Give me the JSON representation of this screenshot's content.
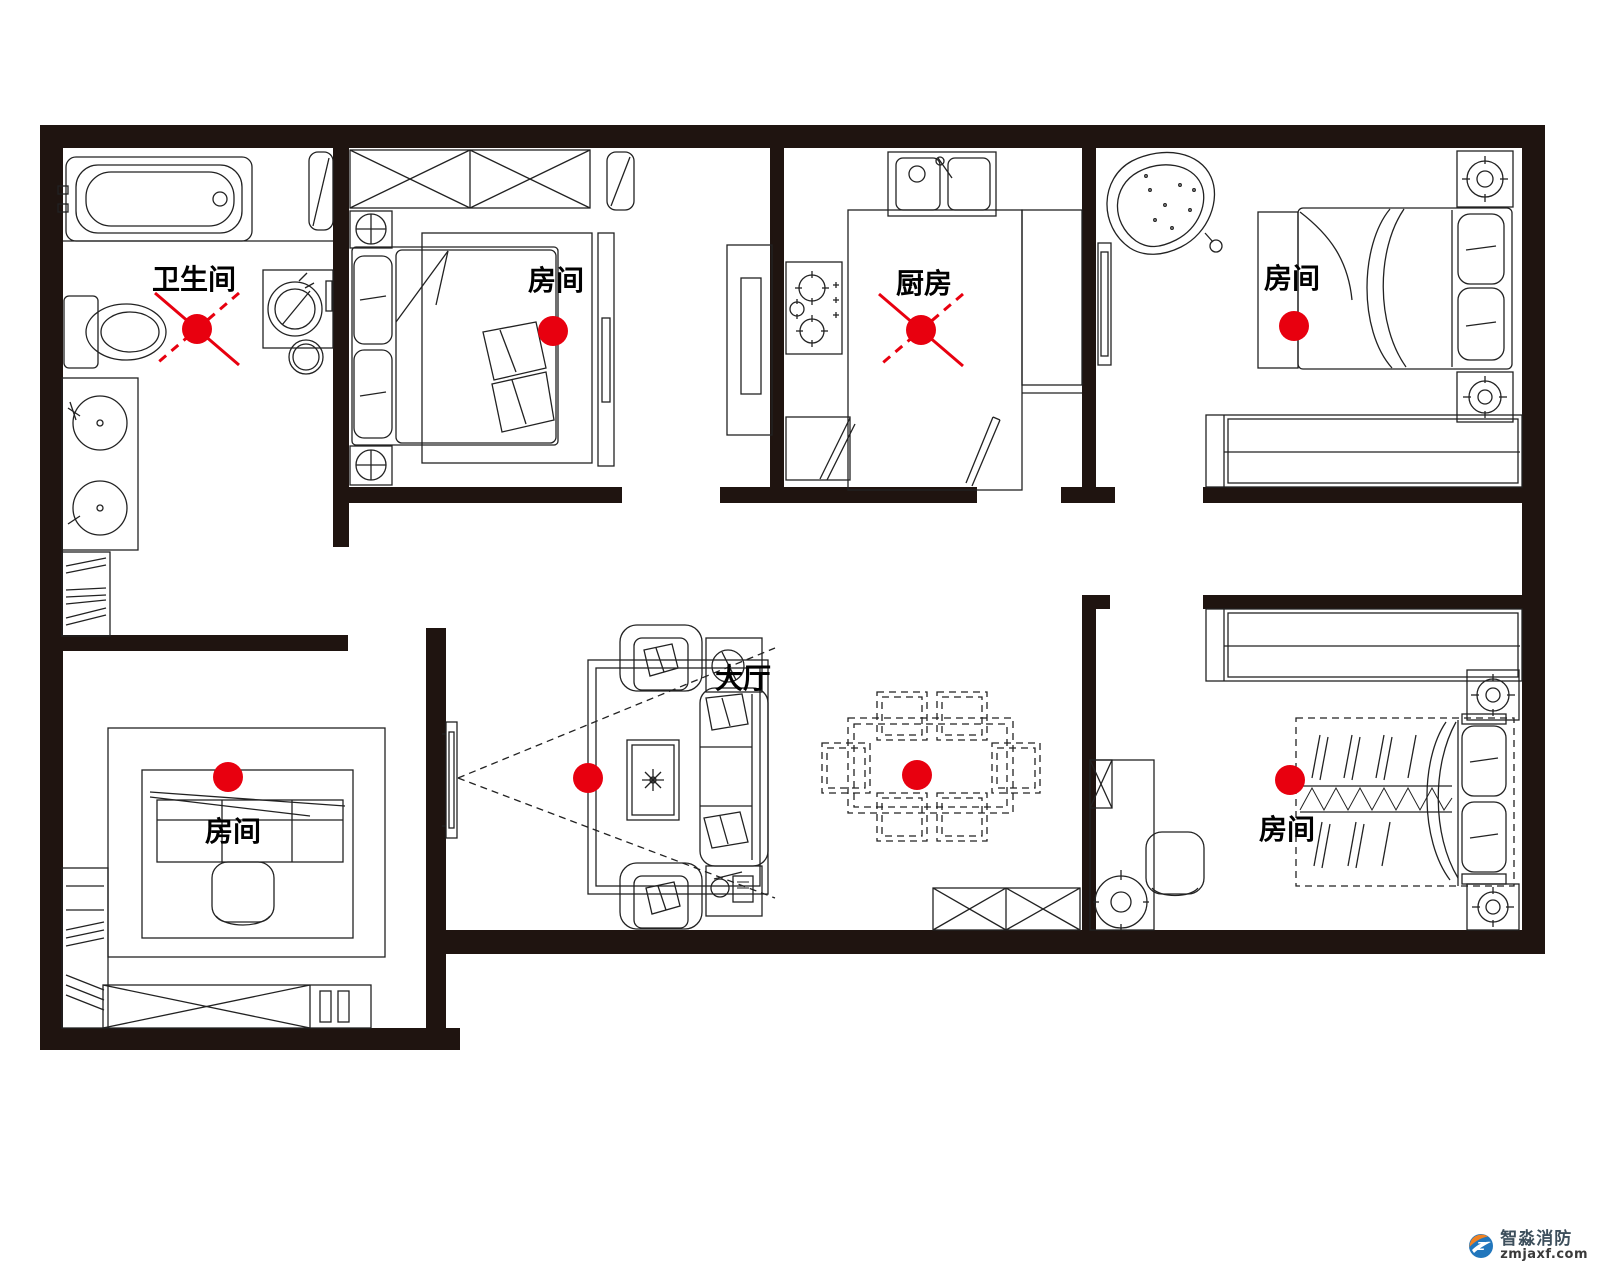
{
  "title": "户型烟感探测器布点平面图",
  "colors": {
    "wall": "#1f1410",
    "line": "#222222",
    "detector_red": "#e8000f",
    "cross_red": "#e8000f",
    "label_black": "#000000"
  },
  "rooms": [
    {
      "id": "bathroom",
      "label": "卫生间",
      "label_x": 194,
      "label_y": 278
    },
    {
      "id": "bedroom-top-left",
      "label": "房间",
      "label_x": 556,
      "label_y": 279
    },
    {
      "id": "kitchen",
      "label": "厨房",
      "label_x": 924,
      "label_y": 282
    },
    {
      "id": "bedroom-top-right",
      "label": "房间",
      "label_x": 1292,
      "label_y": 277
    },
    {
      "id": "living-room",
      "label": "大厅",
      "label_x": 743,
      "label_y": 677
    },
    {
      "id": "bedroom-bottom-left",
      "label": "房间",
      "label_x": 233,
      "label_y": 830
    },
    {
      "id": "bedroom-bottom-right",
      "label": "房间",
      "label_x": 1287,
      "label_y": 828
    }
  ],
  "detectors": [
    {
      "room": "bathroom",
      "x": 197,
      "y": 329,
      "crossed": true
    },
    {
      "room": "bedroom-top-left",
      "x": 553,
      "y": 331,
      "crossed": false
    },
    {
      "room": "kitchen",
      "x": 921,
      "y": 330,
      "crossed": true
    },
    {
      "room": "bedroom-top-right",
      "x": 1294,
      "y": 326,
      "crossed": false
    },
    {
      "room": "bedroom-bottom-left",
      "x": 228,
      "y": 777,
      "crossed": false
    },
    {
      "room": "living-room",
      "x": 588,
      "y": 778,
      "crossed": false
    },
    {
      "room": "dining-area",
      "x": 917,
      "y": 775,
      "crossed": false
    },
    {
      "room": "bedroom-bottom-right",
      "x": 1290,
      "y": 780,
      "crossed": false
    }
  ],
  "watermark": {
    "brand": "智淼消防",
    "domain": "zmjaxf.com",
    "brand_color": "#3d4f5c",
    "domain_color": "#3a3a3a",
    "icon_orange": "#f08122",
    "icon_blue": "#2176bc"
  }
}
